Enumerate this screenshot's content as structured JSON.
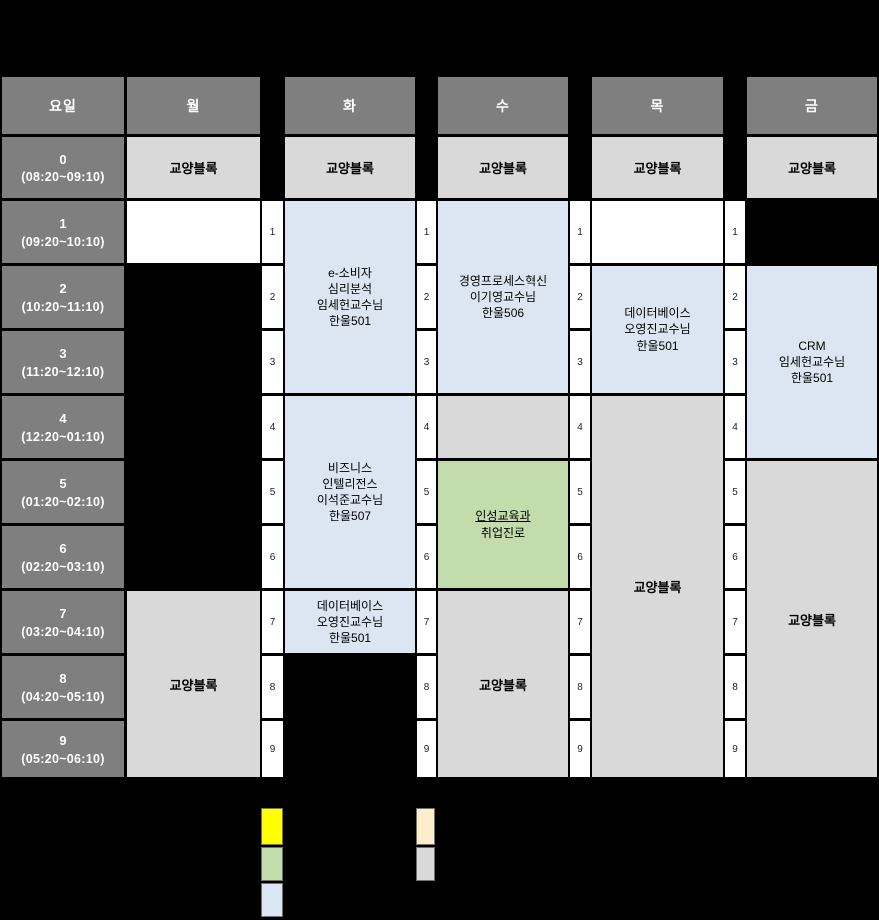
{
  "header": {
    "corner": "요일",
    "days": [
      "월",
      "화",
      "수",
      "목",
      "금"
    ]
  },
  "time_column": [
    {
      "period": "0",
      "range": "(08:20~09:10)"
    },
    {
      "period": "1",
      "range": "(09:20~10:10)"
    },
    {
      "period": "2",
      "range": "(10:20~11:10)"
    },
    {
      "period": "3",
      "range": "(11:20~12:10)"
    },
    {
      "period": "4",
      "range": "(12:20~01:10)"
    },
    {
      "period": "5",
      "range": "(01:20~02:10)"
    },
    {
      "period": "6",
      "range": "(02:20~03:10)"
    },
    {
      "period": "7",
      "range": "(03:20~04:10)"
    },
    {
      "period": "8",
      "range": "(04:20~05:10)"
    },
    {
      "period": "9",
      "range": "(05:20~06:10)"
    }
  ],
  "labels": {
    "liberal_block": "교양블록"
  },
  "period_numbers": [
    "1",
    "2",
    "3",
    "4",
    "5",
    "6",
    "7",
    "8",
    "9"
  ],
  "classes": {
    "tue_p1_3": "e-소비자\n심리분석\n임세헌교수님\n한울501",
    "tue_p4_6": "비즈니스\n인텔리전스\n이석준교수님\n한울507",
    "tue_p7": "데이터베이스\n오영진교수님\n한울501",
    "wed_p1_3": "경영프로세스혁신\n이기영교수님\n한울506",
    "wed_p5_6_line1": "인성교육과",
    "wed_p5_6_line2": "취업진로",
    "thu_p2_3": "데이터베이스\n오영진교수님\n한울501",
    "fri_p2_4": "CRM\n임세헌교수님\n한울501"
  },
  "colors": {
    "background": "#000000",
    "header_gray": "#7f7f7f",
    "block_gray": "#d9d9d9",
    "class_blue": "#dbe6f2",
    "class_green": "#c3dcab",
    "empty_white": "#ffffff",
    "legend_yellow": "#ffff00",
    "legend_cream": "#fdeecb"
  },
  "legend": {
    "swatches": [
      "yellow",
      "green",
      "light-blue",
      "cream",
      "gray"
    ]
  }
}
